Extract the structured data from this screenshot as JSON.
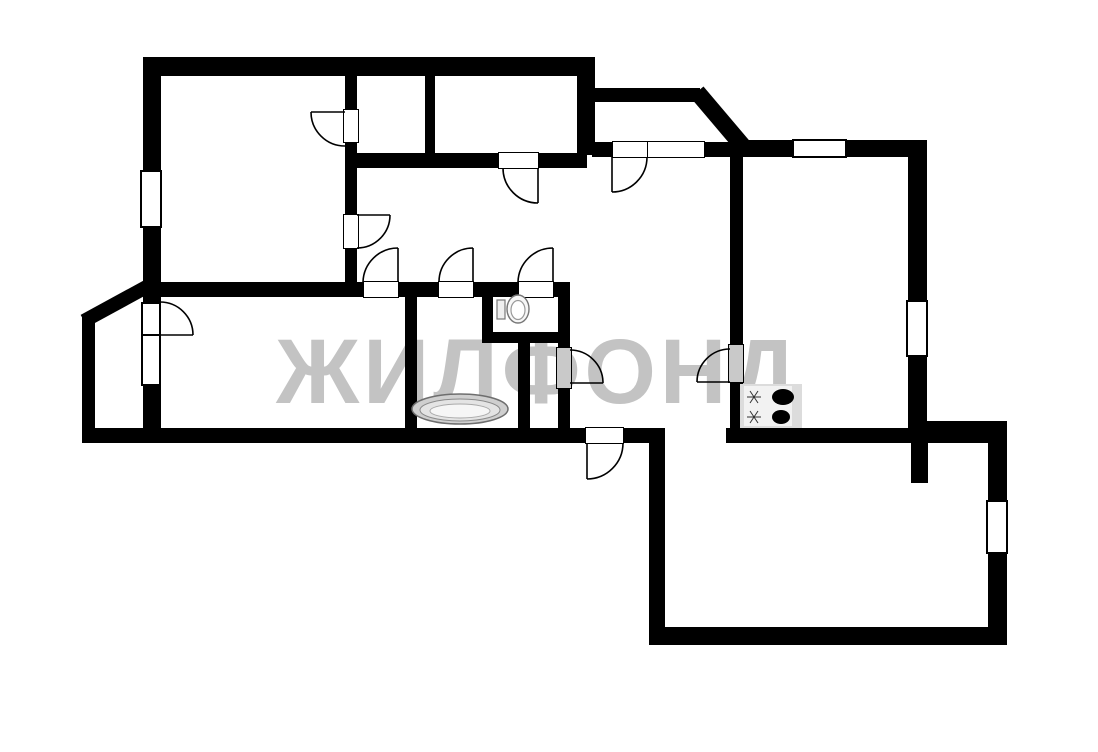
{
  "watermark": {
    "text": "ЖИЛФОНД",
    "color": "#c3c3c3"
  },
  "plan": {
    "background_color": "#ffffff",
    "wall_color": "#000000",
    "door_leaf_color": "#c9c9c9",
    "fixture_colors": {
      "bathtub": "#d9d9d9",
      "stove": "#dcdcdc",
      "burner": "#000000"
    }
  },
  "fixtures": [
    {
      "name": "toilet-icon"
    },
    {
      "name": "bathtub-icon"
    },
    {
      "name": "stove-icon"
    }
  ]
}
